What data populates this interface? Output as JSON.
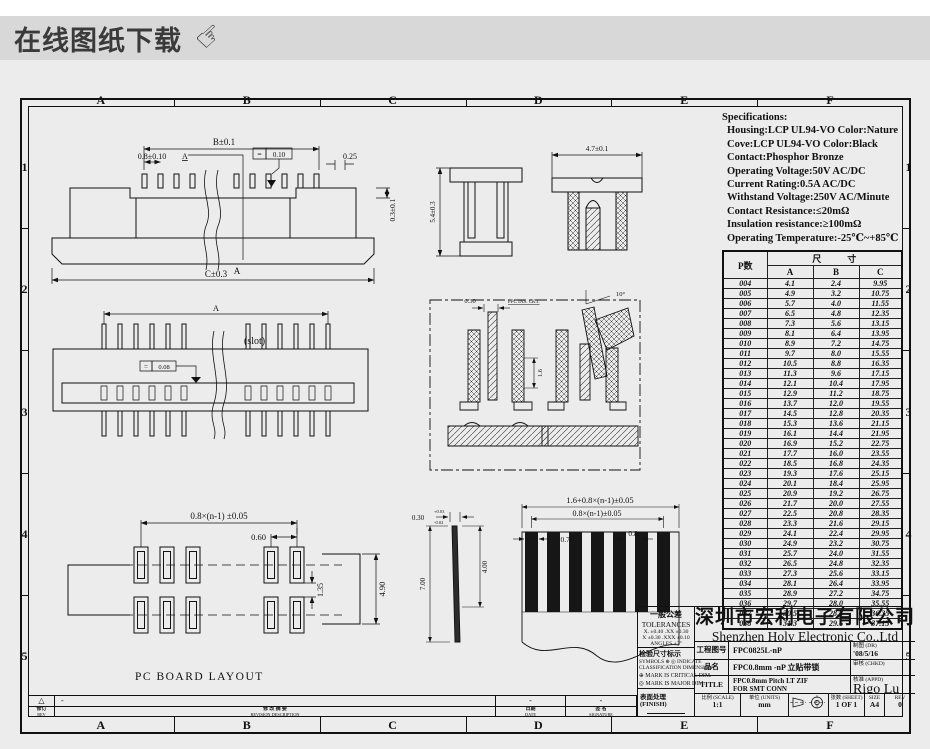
{
  "banner": {
    "title": "在线图纸下载"
  },
  "frame": {
    "columns": [
      "A",
      "B",
      "C",
      "D",
      "E",
      "F"
    ],
    "rows": [
      "1",
      "2",
      "3",
      "4",
      "5"
    ]
  },
  "specs": {
    "title": "Specifications:",
    "lines": [
      "Housing:LCP UL94-VO Color:Nature",
      "Cove:LCP UL94-VO Color:Black",
      "Contact:Phosphor Bronze",
      "Operating Voltage:50V AC/DC",
      "Current Rating:0.5A AC/DC",
      "Withstand Voltage:250V AC/Minute",
      "Contact Resistance:≤20mΩ",
      "Insulation resistance:≥100mΩ",
      "Operating Temperature:-25℃~+85℃"
    ]
  },
  "dim_table": {
    "pin_header": "P数",
    "group_header": "尺寸",
    "cols": [
      "A",
      "B",
      "C"
    ],
    "rows": [
      [
        "004",
        "4.1",
        "2.4",
        "9.95"
      ],
      [
        "005",
        "4.9",
        "3.2",
        "10.75"
      ],
      [
        "006",
        "5.7",
        "4.0",
        "11.55"
      ],
      [
        "007",
        "6.5",
        "4.8",
        "12.35"
      ],
      [
        "008",
        "7.3",
        "5.6",
        "13.15"
      ],
      [
        "009",
        "8.1",
        "6.4",
        "13.95"
      ],
      [
        "010",
        "8.9",
        "7.2",
        "14.75"
      ],
      [
        "011",
        "9.7",
        "8.0",
        "15.55"
      ],
      [
        "012",
        "10.5",
        "8.8",
        "16.35"
      ],
      [
        "013",
        "11.3",
        "9.6",
        "17.15"
      ],
      [
        "014",
        "12.1",
        "10.4",
        "17.95"
      ],
      [
        "015",
        "12.9",
        "11.2",
        "18.75"
      ],
      [
        "016",
        "13.7",
        "12.0",
        "19.55"
      ],
      [
        "017",
        "14.5",
        "12.8",
        "20.35"
      ],
      [
        "018",
        "15.3",
        "13.6",
        "21.15"
      ],
      [
        "019",
        "16.1",
        "14.4",
        "21.95"
      ],
      [
        "020",
        "16.9",
        "15.2",
        "22.75"
      ],
      [
        "021",
        "17.7",
        "16.0",
        "23.55"
      ],
      [
        "022",
        "18.5",
        "16.8",
        "24.35"
      ],
      [
        "023",
        "19.3",
        "17.6",
        "25.15"
      ],
      [
        "024",
        "20.1",
        "18.4",
        "25.95"
      ],
      [
        "025",
        "20.9",
        "19.2",
        "26.75"
      ],
      [
        "026",
        "21.7",
        "20.0",
        "27.55"
      ],
      [
        "027",
        "22.5",
        "20.8",
        "28.35"
      ],
      [
        "028",
        "23.3",
        "21.6",
        "29.15"
      ],
      [
        "029",
        "24.1",
        "22.4",
        "29.95"
      ],
      [
        "030",
        "24.9",
        "23.2",
        "30.75"
      ],
      [
        "031",
        "25.7",
        "24.0",
        "31.55"
      ],
      [
        "032",
        "26.5",
        "24.8",
        "32.35"
      ],
      [
        "033",
        "27.3",
        "25.6",
        "33.15"
      ],
      [
        "034",
        "28.1",
        "26.4",
        "33.95"
      ],
      [
        "035",
        "28.9",
        "27.2",
        "34.75"
      ],
      [
        "036",
        "29.7",
        "28.0",
        "35.55"
      ],
      [
        "037",
        "30.5",
        "28.8",
        "36.35"
      ],
      [
        "038",
        "31.3",
        "29.6",
        "37.15"
      ]
    ]
  },
  "drawings": {
    "side_view": {
      "dim_top": "B±0.1",
      "dim_pitch": "0.8±0.10",
      "section_mark": "A",
      "gdt_symbol": "=",
      "gdt_value": "0.10",
      "dim_right_small": "0.25",
      "dim_lip": "0.3±0.1",
      "dim_bottom": "C±0.3"
    },
    "top_view": {
      "dim_top": "A",
      "slot": "(slot)",
      "gdt_symbol": "=",
      "gdt_value": "0.08"
    },
    "pcb": {
      "dim_pitch": "0.8×(n-1) ±0.05",
      "dim_pad": "0.60",
      "dim_gap": "1.35",
      "dim_span": "4.90",
      "caption": "PC BOARD LAYOUT"
    },
    "front_views": {
      "dim_height": "5.4±0.3",
      "dim_width": "4.7±0.1"
    },
    "sections": {
      "dim_fpc": "0.30",
      "note": "FPC INS. CKT.",
      "dim_depth": "1.6",
      "angle": "10°"
    },
    "fpc": {
      "dim_total": "1.6+0.8×(n-1)±0.05",
      "dim_pitch": "0.8×(n-1)±0.05",
      "dim_finger": "0.70",
      "dim_space": "0.8",
      "dim_thickness": "0.30",
      "dim_th_up": "+0.03",
      "dim_th_dn": "-0.02",
      "dim_len1": "7.00",
      "dim_len2": "4.00"
    }
  },
  "tolerances": {
    "title_cn": "一般公差",
    "title_en": "TOLERANCES",
    "line1": "X. ±0.40   .XX ±0.30",
    "line2": "X  ±0.30   .XXX ±0.10",
    "angles": "ANGLES   ±3°"
  },
  "inspection": {
    "title": "检验尺寸标示",
    "line1": "SYMBOLS ⊕ ◎ INDICATE",
    "line2": "CLASSIFICATION DIMENSION",
    "mark1": "⊕ MARK IS CRITICAL DIM.",
    "mark2": "◎ MARK IS MAJOR DIM."
  },
  "finish_label": "表面处理 (FINISH)",
  "revision": {
    "mark": "△",
    "desc_value": "-",
    "date_value": "-",
    "sign_value": "-",
    "rev_cn": "修订",
    "rev_en": "REV",
    "desc_cn": "修 改 摘 要",
    "desc_en": "REVISION DESCRIPTION",
    "date_cn": "日期",
    "date_en": "DATE",
    "sign_cn": "签 名",
    "sign_en": "SIGNATURE"
  },
  "title_block": {
    "company_cn": "深圳市宏利电子有限公司",
    "company_en": "Shenzhen Holy Electronic Co.,Ltd",
    "drawing_no_label": "工程图号",
    "drawing_no": "FPC0825L-nP",
    "dr_label": "制图 (DR)",
    "dr_value": "'08/5/16",
    "part_label": "品名",
    "part_name": "FPC0.8mm -nP 立贴带锁",
    "chkd_label": "审核 (CHKD)",
    "chkd_value": "",
    "title_label": "TITLE",
    "title_line1": "FPC0.8mm Pitch LT ZIF",
    "title_line2": "FOR SMT CONN",
    "appd_label": "核准 (APPD)",
    "appd_value": "Rigo Lu",
    "scale_label": "比例 (SCALE)",
    "scale": "1:1",
    "units_label": "单位 (UNITS)",
    "units": "mm",
    "sheet_label": "张数 (SHEET)",
    "sheet": "1 OF 1",
    "size_label": "SIZE",
    "size": "A4",
    "rev_label": "REV",
    "rev": "0"
  }
}
